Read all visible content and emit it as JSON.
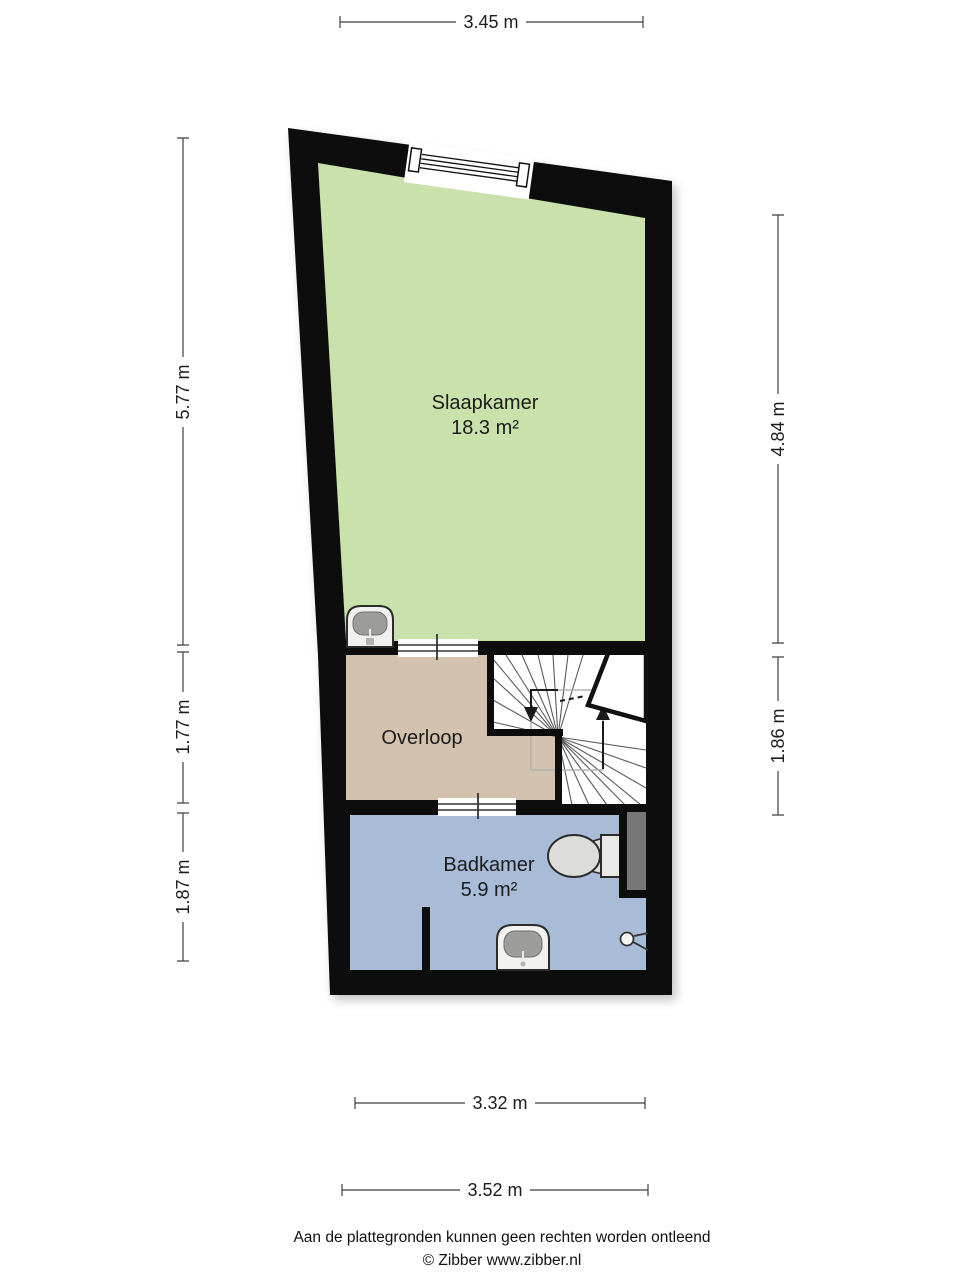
{
  "plan": {
    "rooms": [
      {
        "id": "slaapkamer",
        "name": "Slaapkamer",
        "area": "18.3 m²",
        "color": "#c9e1ab"
      },
      {
        "id": "overloop",
        "name": "Overloop",
        "area": "",
        "color": "#d3c3ae"
      },
      {
        "id": "badkamer",
        "name": "Badkamer",
        "area": "5.9 m²",
        "color": "#a8bcd8"
      }
    ],
    "wall_color": "#0d0d0d",
    "stairs_color": "#ffffff",
    "panel_color": "#777777",
    "fixture_basin_color": "#9c9c9a"
  },
  "dimensions": {
    "top": "3.45 m",
    "left_upper": "5.77 m",
    "left_middle": "1.77 m",
    "left_lower": "1.87 m",
    "right_upper": "4.84 m",
    "right_lower": "1.86 m",
    "bottom_upper": "3.32 m",
    "bottom_lower": "3.52 m"
  },
  "footer": {
    "disclaimer": "Aan de plattegronden kunnen geen rechten worden ontleend",
    "copyright": "© Zibber www.zibber.nl"
  }
}
